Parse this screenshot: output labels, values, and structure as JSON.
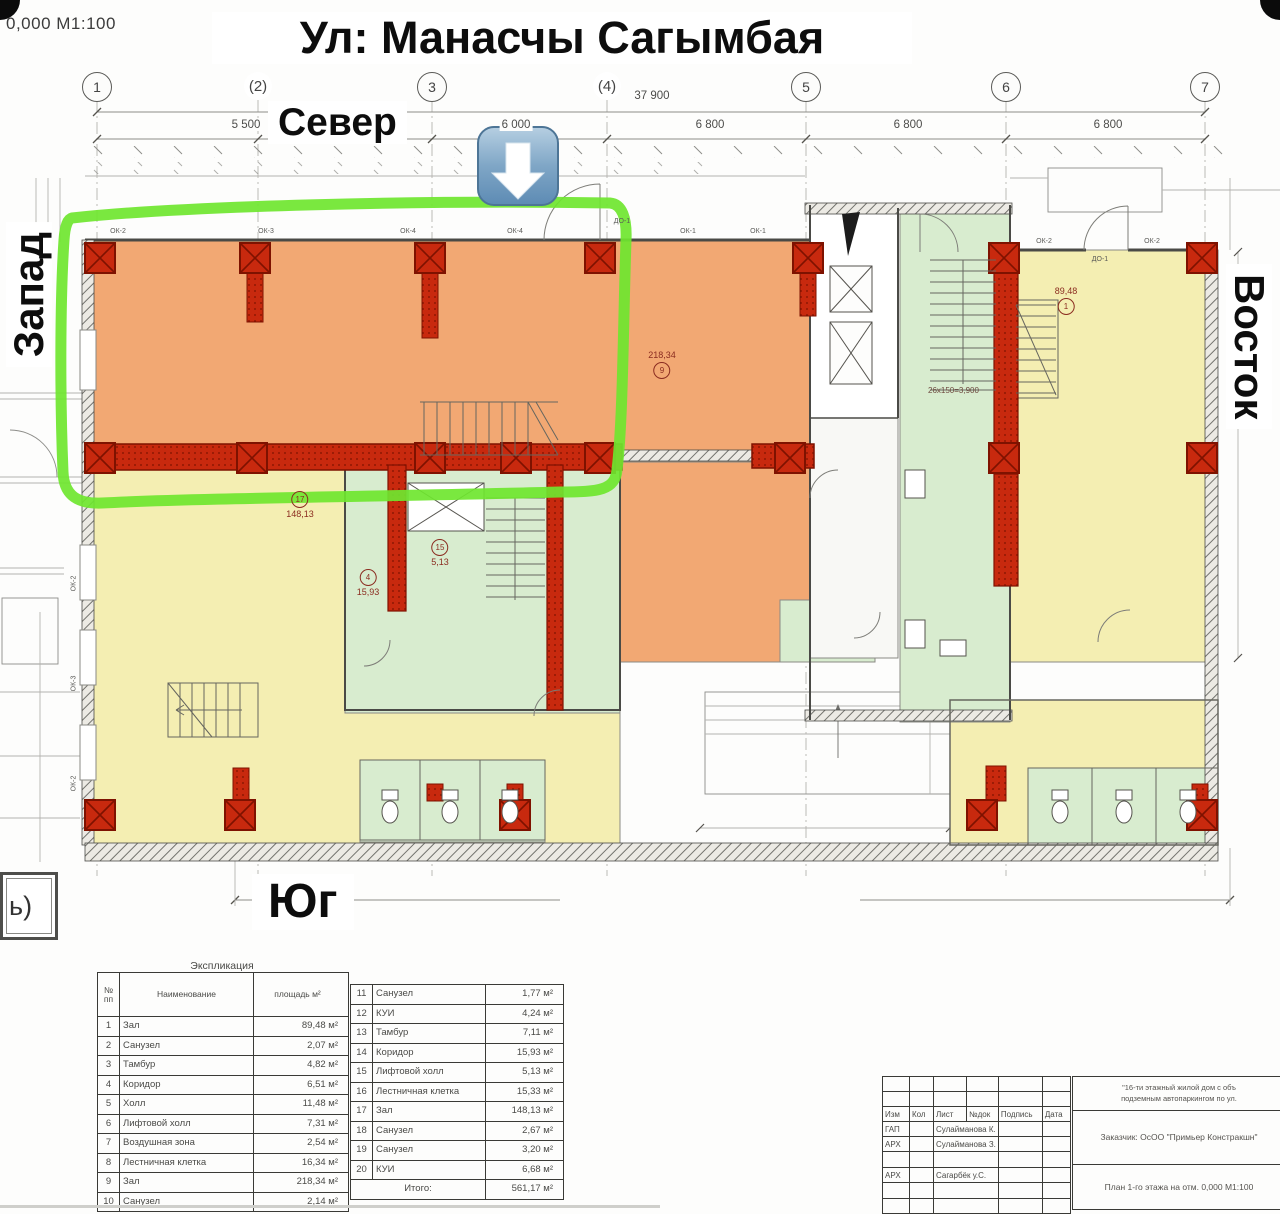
{
  "header": {
    "scale_note": "0,000 М1:100",
    "street_title": "Ул: Манасчы Сагымбая"
  },
  "compass": {
    "north": "Север",
    "south": "Юг",
    "west": "Запад",
    "east": "Восток"
  },
  "grid": {
    "axes": [
      "1",
      "(2)",
      "3",
      "(4)",
      "5",
      "6",
      "7"
    ],
    "overall_dim": "37 900",
    "segment_dims": [
      "5 500",
      "6 000",
      "6 800",
      "6 800",
      "6 800"
    ]
  },
  "plan": {
    "highlight_color": "#6fe62f",
    "colors": {
      "hall_orange": "#f2a873",
      "hall_yellow": "#f4eeb2",
      "service_green": "#d8eccf",
      "column_red": "#c8290e"
    },
    "stair_note": "26х150=3,900",
    "door_labels": [
      "ДО-1",
      "ДО-1"
    ],
    "window_labels_north": [
      "ОК-2",
      "ОК-3",
      "ОК-4",
      "ОК-4",
      "ОК-1",
      "ОК-1",
      "ОК-2",
      "ОК-2"
    ],
    "window_labels_west": [
      "ОК-2",
      "ОК-3",
      "ОК-2"
    ],
    "room_tags": [
      {
        "num": "9",
        "area": "218,34"
      },
      {
        "num": "17",
        "area": "148,13"
      },
      {
        "num": "1",
        "area": "89,48"
      },
      {
        "num": "4",
        "area": "15,93"
      },
      {
        "num": "15",
        "area": "5,13"
      }
    ],
    "corner_note": "ь)"
  },
  "explication": {
    "title": "Экспликация",
    "headers": {
      "num": "№ пп",
      "name": "Наименование",
      "area": "площадь м²"
    },
    "rows1": [
      {
        "num": "1",
        "name": "Зал",
        "area": "89,48 м²"
      },
      {
        "num": "2",
        "name": "Санузел",
        "area": "2,07 м²"
      },
      {
        "num": "3",
        "name": "Тамбур",
        "area": "4,82 м²"
      },
      {
        "num": "4",
        "name": "Коридор",
        "area": "6,51 м²"
      },
      {
        "num": "5",
        "name": "Холл",
        "area": "11,48 м²"
      },
      {
        "num": "6",
        "name": "Лифтовой холл",
        "area": "7,31 м²"
      },
      {
        "num": "7",
        "name": "Воздушная зона",
        "area": "2,54 м²"
      },
      {
        "num": "8",
        "name": "Лестничная клетка",
        "area": "16,34 м²"
      },
      {
        "num": "9",
        "name": "Зал",
        "area": "218,34 м²"
      },
      {
        "num": "10",
        "name": "Санузел",
        "area": "2,14 м²"
      }
    ],
    "rows2": [
      {
        "num": "11",
        "name": "Санузел",
        "area": "1,77 м²"
      },
      {
        "num": "12",
        "name": "КУИ",
        "area": "4,24 м²"
      },
      {
        "num": "13",
        "name": "Тамбур",
        "area": "7,11 м²"
      },
      {
        "num": "14",
        "name": "Коридор",
        "area": "15,93 м²"
      },
      {
        "num": "15",
        "name": "Лифтовой холл",
        "area": "5,13 м²"
      },
      {
        "num": "16",
        "name": "Лестничная клетка",
        "area": "15,33 м²"
      },
      {
        "num": "17",
        "name": "Зал",
        "area": "148,13 м²"
      },
      {
        "num": "18",
        "name": "Санузел",
        "area": "2,67 м²"
      },
      {
        "num": "19",
        "name": "Санузел",
        "area": "3,20 м²"
      },
      {
        "num": "20",
        "name": "КУИ",
        "area": "6,68 м²"
      }
    ],
    "total_label": "Итого:",
    "total_value": "561,17 м²"
  },
  "stamp": {
    "columns": [
      "Изм",
      "Кол",
      "Лист",
      "№док",
      "Подпись",
      "Дата"
    ],
    "signers": [
      {
        "role": "ГАП",
        "name": "Сулайманова К."
      },
      {
        "role": "АРХ",
        "name": "Сулайманова З."
      },
      {
        "role": "АРХ",
        "name": "Сагарбёк у.С."
      }
    ],
    "project_line1": "\"16-ти этажный жилой дом с объ",
    "project_line2": "подземным автопаркингом по ул.",
    "client": "Заказчик: ОсОО \"Примьер Констракшн\"",
    "sheet_title": "План 1-го этажа на отм. 0,000 М1:100"
  }
}
